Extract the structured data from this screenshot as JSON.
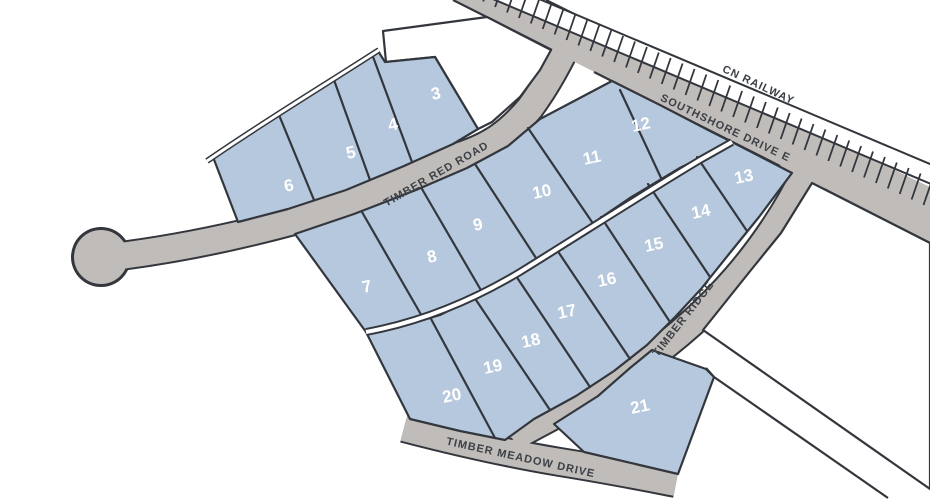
{
  "map": {
    "type": "subdivision-plat-map",
    "colors": {
      "lot_fill": "#b6c8dd",
      "road_fill": "#c0bcb9",
      "outline": "#33373d",
      "road_label_color": "#3c4147",
      "lot_number_color": "#ffffff",
      "background": "#ffffff"
    },
    "roads": {
      "railway": {
        "label": "CN RAILWAY"
      },
      "southshore": {
        "label": "SOUTHSHORE DRIVE E"
      },
      "timber_red": {
        "label": "TIMBER RED ROAD"
      },
      "timber_ridge": {
        "label": "TIMBER RIDGE"
      },
      "timber_meadow": {
        "label": "TIMBER MEADOW DRIVE"
      }
    },
    "lots": [
      {
        "number": "3"
      },
      {
        "number": "4"
      },
      {
        "number": "5"
      },
      {
        "number": "6"
      },
      {
        "number": "7"
      },
      {
        "number": "8"
      },
      {
        "number": "9"
      },
      {
        "number": "10"
      },
      {
        "number": "11"
      },
      {
        "number": "12"
      },
      {
        "number": "13"
      },
      {
        "number": "14"
      },
      {
        "number": "15"
      },
      {
        "number": "16"
      },
      {
        "number": "17"
      },
      {
        "number": "18"
      },
      {
        "number": "19"
      },
      {
        "number": "20"
      },
      {
        "number": "21"
      }
    ]
  }
}
